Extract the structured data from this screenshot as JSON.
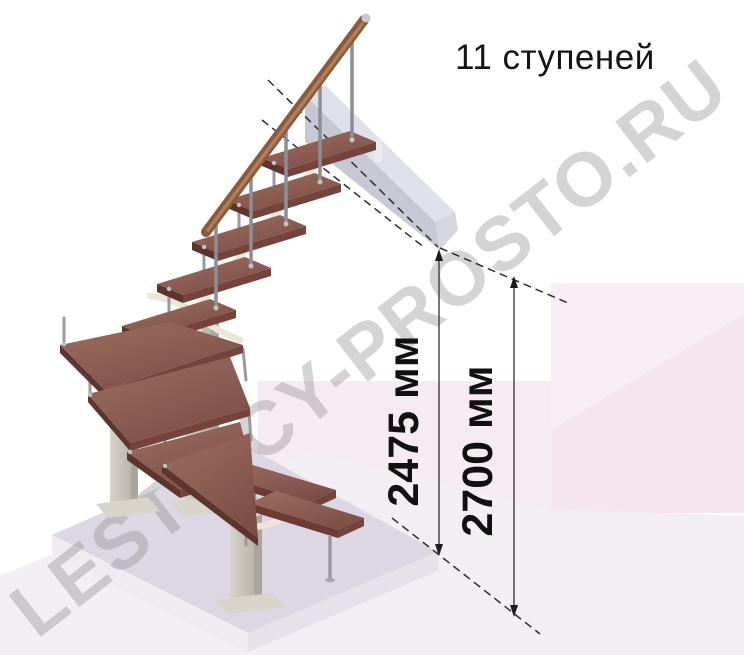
{
  "title": "11 ступеней",
  "dimensions": {
    "stair_height": "2475 мм",
    "floor_height": "2700 мм"
  },
  "watermark": "LESTNICY-PROSTO.RU",
  "figure": {
    "kind": "3d-staircase-render",
    "steps_count": 11
  },
  "colors": {
    "tread_light": "#9d6f63",
    "tread_dark": "#7c4e46",
    "tread_edge": "#5e352e",
    "tread_front": "#74443c",
    "handrail": "#8a5a3c",
    "handrail_highlight": "#b07e58",
    "metal": "#c9c5bd",
    "landing_gray": "#c8c8d5",
    "wall_pink": "#f9eef5",
    "wall_pink_deep": "#f5e6ee",
    "floor_pink": "#f7ebf2",
    "floor_light": "#f3edf4",
    "plinth": "#dcd7e2",
    "bracket_cream": "#ece6d8",
    "dimension_line": "#3f3f3f",
    "watermark": "#8f8f8f"
  }
}
